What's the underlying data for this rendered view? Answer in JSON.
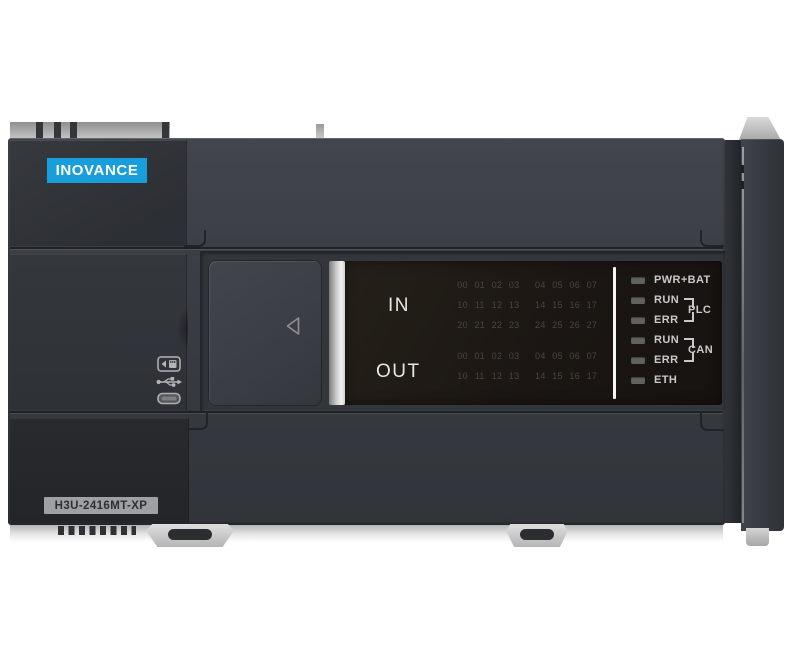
{
  "device": {
    "brand": "INOVANCE",
    "model": "H3U-2416MT-XP"
  },
  "display": {
    "in_label": "IN",
    "out_label": "OUT",
    "in_rows": [
      [
        "00",
        "01",
        "02",
        "03",
        "04",
        "05",
        "06",
        "07"
      ],
      [
        "10",
        "11",
        "12",
        "13",
        "14",
        "15",
        "16",
        "17"
      ],
      [
        "20",
        "21",
        "22",
        "23",
        "24",
        "25",
        "26",
        "27"
      ]
    ],
    "out_rows": [
      [
        "00",
        "01",
        "02",
        "03",
        "04",
        "05",
        "06",
        "07"
      ],
      [
        "10",
        "11",
        "12",
        "13",
        "14",
        "15",
        "16",
        "17"
      ]
    ]
  },
  "status_panel": {
    "leds": [
      {
        "label": "PWR+BAT"
      },
      {
        "label": "RUN"
      },
      {
        "label": "ERR"
      },
      {
        "label": "RUN"
      },
      {
        "label": "ERR"
      },
      {
        "label": "ETH"
      }
    ],
    "groups": [
      {
        "label": "PLC"
      },
      {
        "label": "CAN"
      }
    ]
  },
  "ports": {
    "icons": [
      "sd-card-icon",
      "usb-icon",
      "mini-usb-port-icon"
    ]
  },
  "colors": {
    "brand_blue": "#189fdb",
    "body_charcoal": "#3a3e44",
    "panel_dark": "#2f3237",
    "panel_black": "#26282b",
    "display_black": "#1b1613",
    "led_off": "#62625c",
    "panel_text": "#c9c9c7",
    "model_label_bg": "#9ea1a3"
  }
}
